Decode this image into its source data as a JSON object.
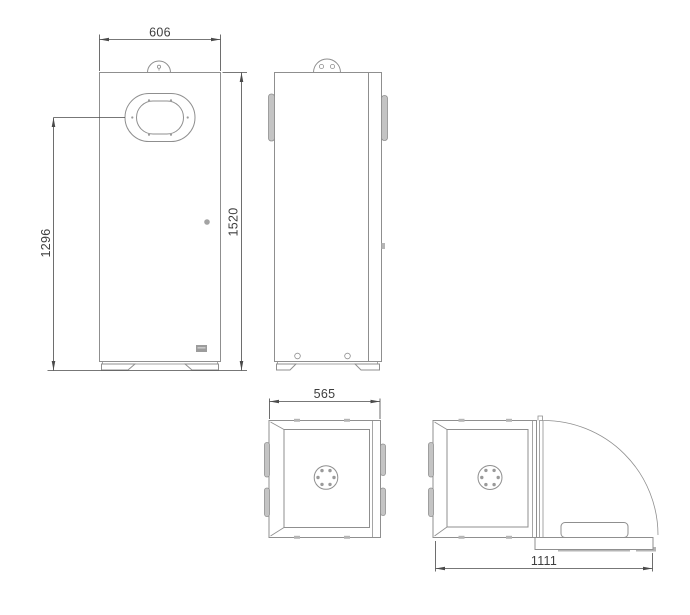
{
  "drawing": {
    "kind": "technical-dimension-drawing",
    "dims": {
      "width": "606",
      "inlet_height": "1296",
      "height": "1520",
      "depth": "565",
      "depth_door_open": "1111"
    },
    "colors": {
      "background": "#ffffff",
      "object_line": "#8f8f8f",
      "dimension_line": "#4a4a4a",
      "dimension_text": "#3e3e3e",
      "gray_fill": "#b5b5b5"
    }
  }
}
